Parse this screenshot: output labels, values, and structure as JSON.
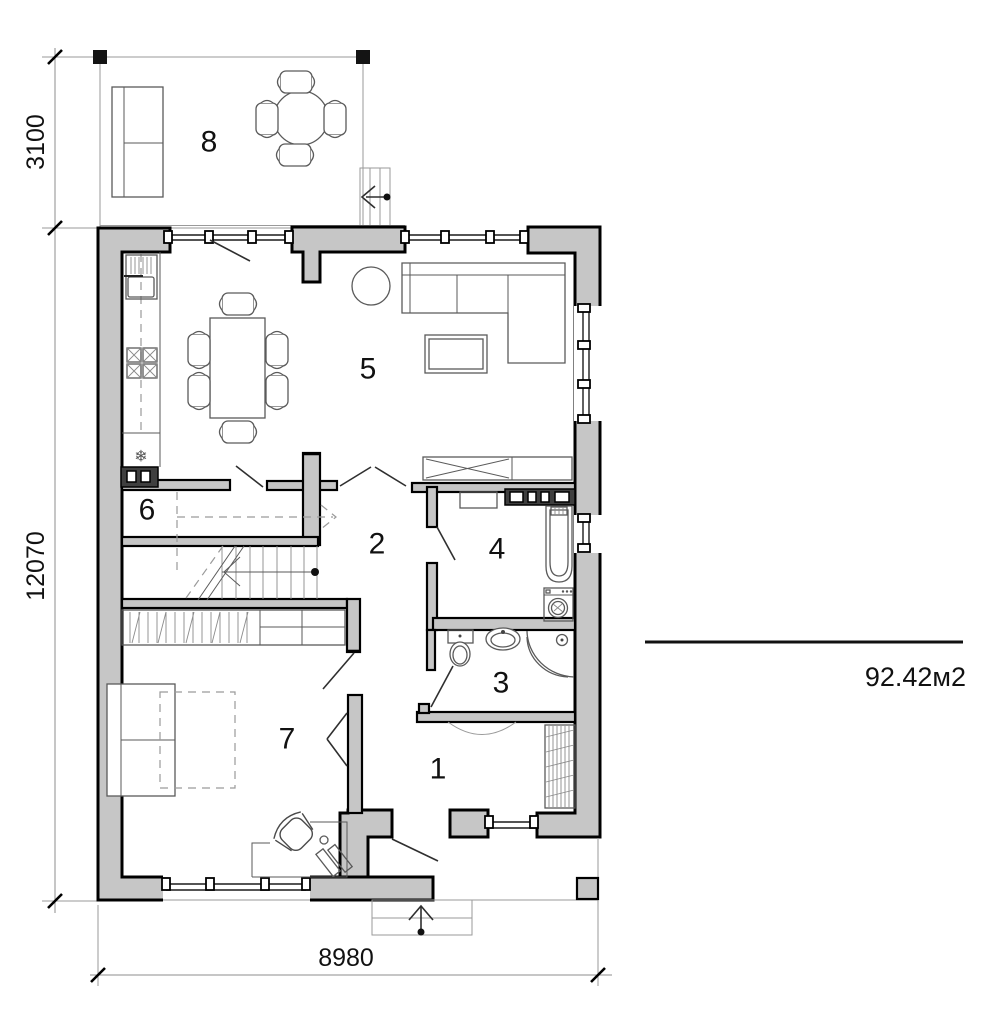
{
  "drawing": {
    "title": "ground-floor-plan",
    "room_labels": {
      "r1": "1",
      "r2": "2",
      "r3": "3",
      "r4": "4",
      "r5": "5",
      "r6": "6",
      "r7": "7",
      "r8": "8"
    },
    "dimensions": {
      "terrace_depth": "3100",
      "house_depth": "12070",
      "house_width": "8980"
    },
    "area_label": "92.42м2",
    "colors": {
      "wall_fill": "#c6c6c6",
      "wall_outline": "#000000",
      "paper": "#ffffff",
      "annotation": "#111111"
    }
  }
}
